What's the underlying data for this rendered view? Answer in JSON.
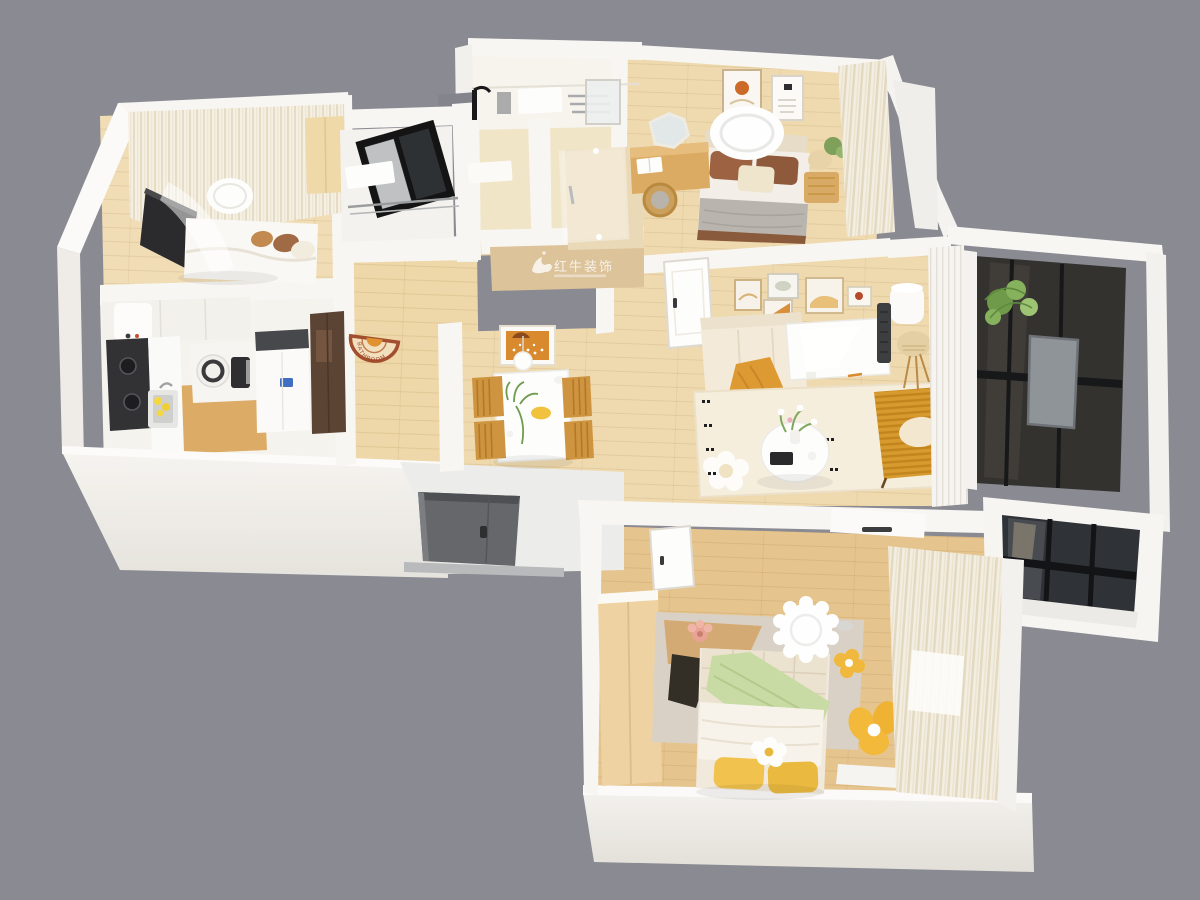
{
  "scene": {
    "type": "3d-isometric-floorplan-render",
    "background_color": "#8a8a92",
    "watermark": {
      "title": "红牛装饰",
      "band_color": "#dcc39a",
      "text_color": "#ffffff"
    },
    "bath_mat_text": "BATHROOM",
    "palette": {
      "wall": "#f7f5f1",
      "wall_face_light": "#f4f2ee",
      "wall_face_dark": "#e7e4de",
      "wood_light": "#efdab0",
      "wood_mid": "#e6c48d",
      "wood_dark": "#cfa45f",
      "corridor_wood": "#eed7a8",
      "bathroom_tile": "#f1e5c8",
      "sofa_cream": "#f3ead9",
      "rug_cream": "#f6eedd",
      "accent_mustard": "#d79a2f",
      "accent_yellow": "#f1c24e",
      "accent_green": "#c9dba4",
      "pillow_brown": "#9c6242",
      "glass_dark": "#33322f",
      "entry_door_grey": "#65676a"
    },
    "rooms": [
      {
        "name": "small-bedroom",
        "position": "top-left",
        "furniture": [
          "bed",
          "tv-panel",
          "curtains",
          "pendant-light",
          "wardrobe"
        ]
      },
      {
        "name": "kitchen",
        "position": "left",
        "furniture": [
          "water-heater",
          "cooktop",
          "sink",
          "lemons",
          "rice-cooker",
          "coffee-maker",
          "fridge",
          "tall-dark-cabinet"
        ]
      },
      {
        "name": "laundry-room",
        "position": "top-center-left",
        "furniture": [
          "black-framed-window",
          "white-shelf",
          "chrome-towel-rail"
        ]
      },
      {
        "name": "bathroom",
        "position": "top-center",
        "furniture": [
          "vanity-counter",
          "black-faucet",
          "mirror",
          "glass-shower-door",
          "bath-mat"
        ]
      },
      {
        "name": "master-bedroom",
        "position": "top-right",
        "furniture": [
          "bed",
          "grey-blanket",
          "brown-pillows",
          "ceiling-light",
          "wall-art",
          "vanity-desk",
          "mirror",
          "wooden-chair",
          "nightstand",
          "table-lamp",
          "plant",
          "curtains"
        ]
      },
      {
        "name": "dining-area",
        "position": "center-left",
        "furniture": [
          "white-dining-table",
          "four-wooden-chairs",
          "pendant-lamp",
          "orange-wall-art",
          "plant",
          "fruit-plate"
        ]
      },
      {
        "name": "living-room",
        "position": "center",
        "furniture": [
          "beige-sofa",
          "orange-throw",
          "white-table",
          "round-coffee-table",
          "flower-vase",
          "cream-rug",
          "flower-rug-accent",
          "mustard-armchair",
          "rattan-floor-lamp",
          "standing-air-conditioner",
          "gallery-wall-frames",
          "white-door"
        ]
      },
      {
        "name": "balcony",
        "position": "right",
        "furniture": [
          "dark-glazing",
          "outdoor-unit-panel",
          "plant",
          "white-louver-partition"
        ]
      },
      {
        "name": "large-bedroom",
        "position": "bottom",
        "furniture": [
          "bed",
          "green-blanket",
          "yellow-pillows",
          "flower-doll",
          "quilted-headboard",
          "wardrobe",
          "patch-rug",
          "flower-chair",
          "scalloped-ceiling-light",
          "wall-air-conditioner",
          "curtains",
          "bay-window",
          "white-door"
        ]
      }
    ],
    "exterior": {
      "entry_door": "dark-grey-door-on-south-wall",
      "walls": "white"
    }
  }
}
